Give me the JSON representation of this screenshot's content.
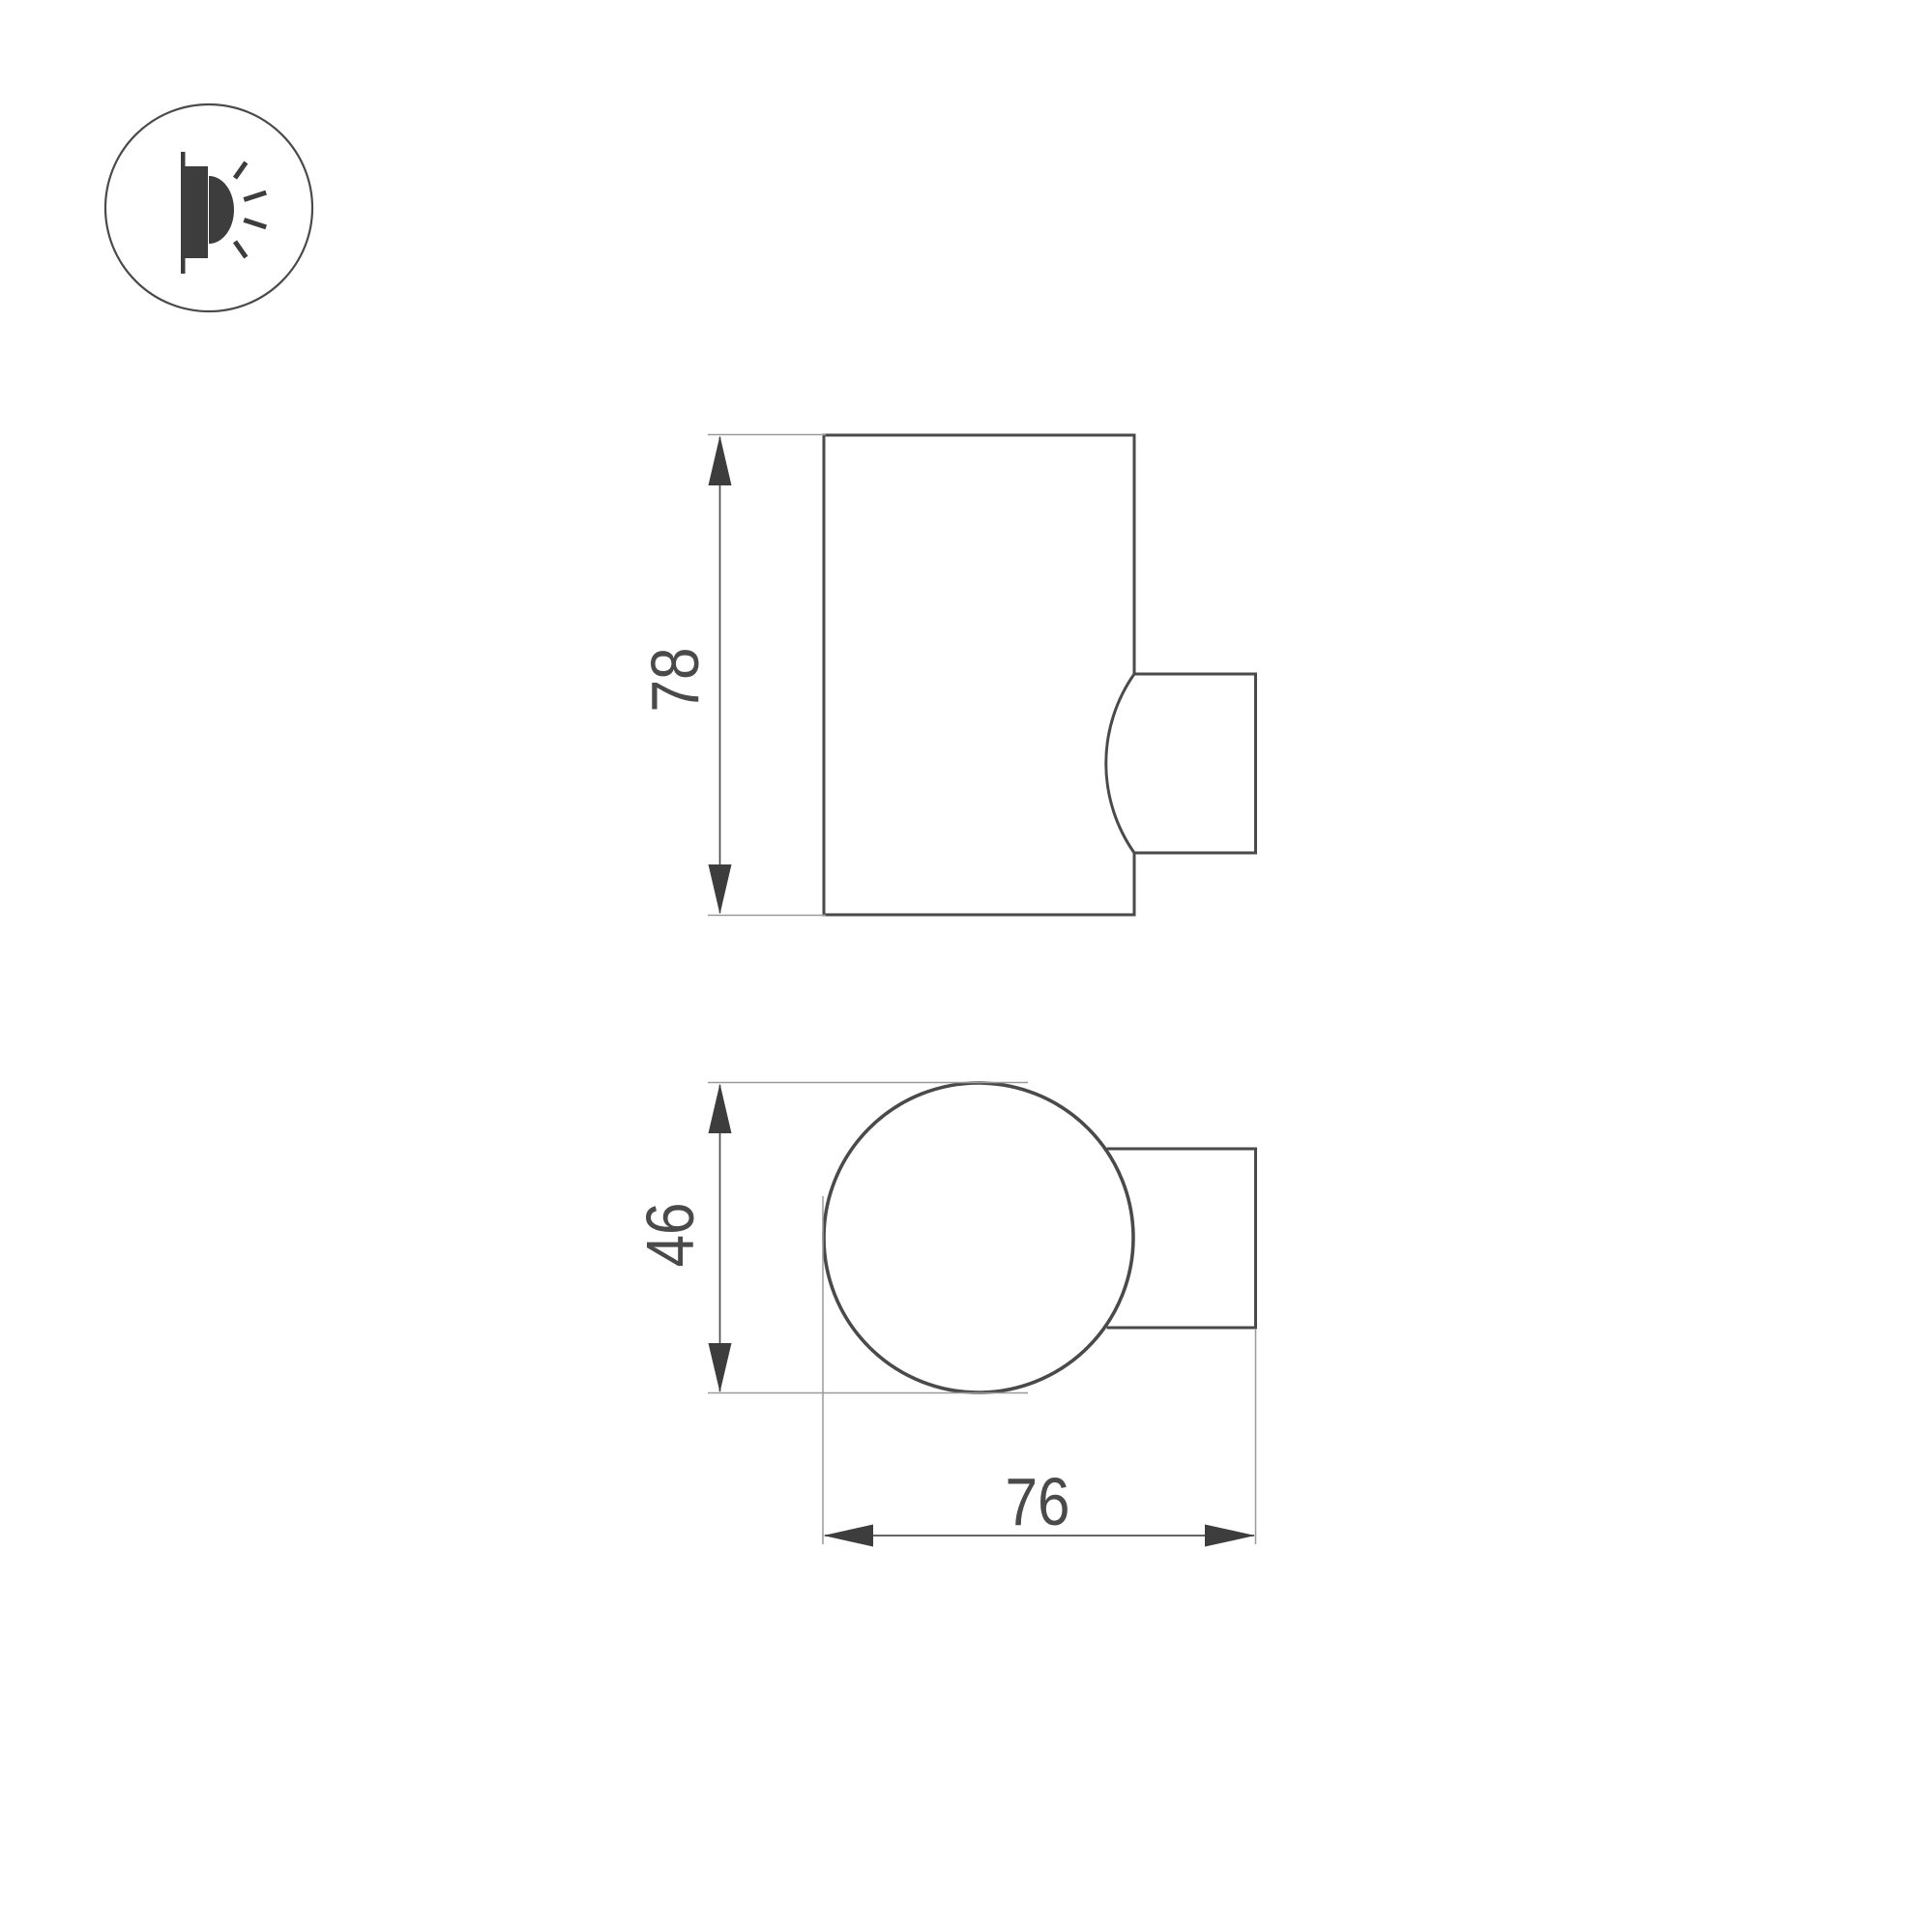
{
  "drawing": {
    "type": "wall-lamp-dimension-drawing",
    "views": {
      "side_view": "cylinder-with-wall-mount",
      "top_view": "circle-with-wall-mount"
    },
    "dimensions": {
      "height_label": "78",
      "diameter_label": "46",
      "depth_label": "76"
    },
    "icon": {
      "name": "wall-light-icon"
    }
  },
  "colors": {
    "bg": "#ffffff",
    "outline": "#4a4a4a",
    "dim": "#4f4f4f",
    "ext": "#9a9a9a",
    "arrow": "#3d3d3d",
    "text": "#4a4a4a",
    "icon": "#3d3d3d"
  }
}
